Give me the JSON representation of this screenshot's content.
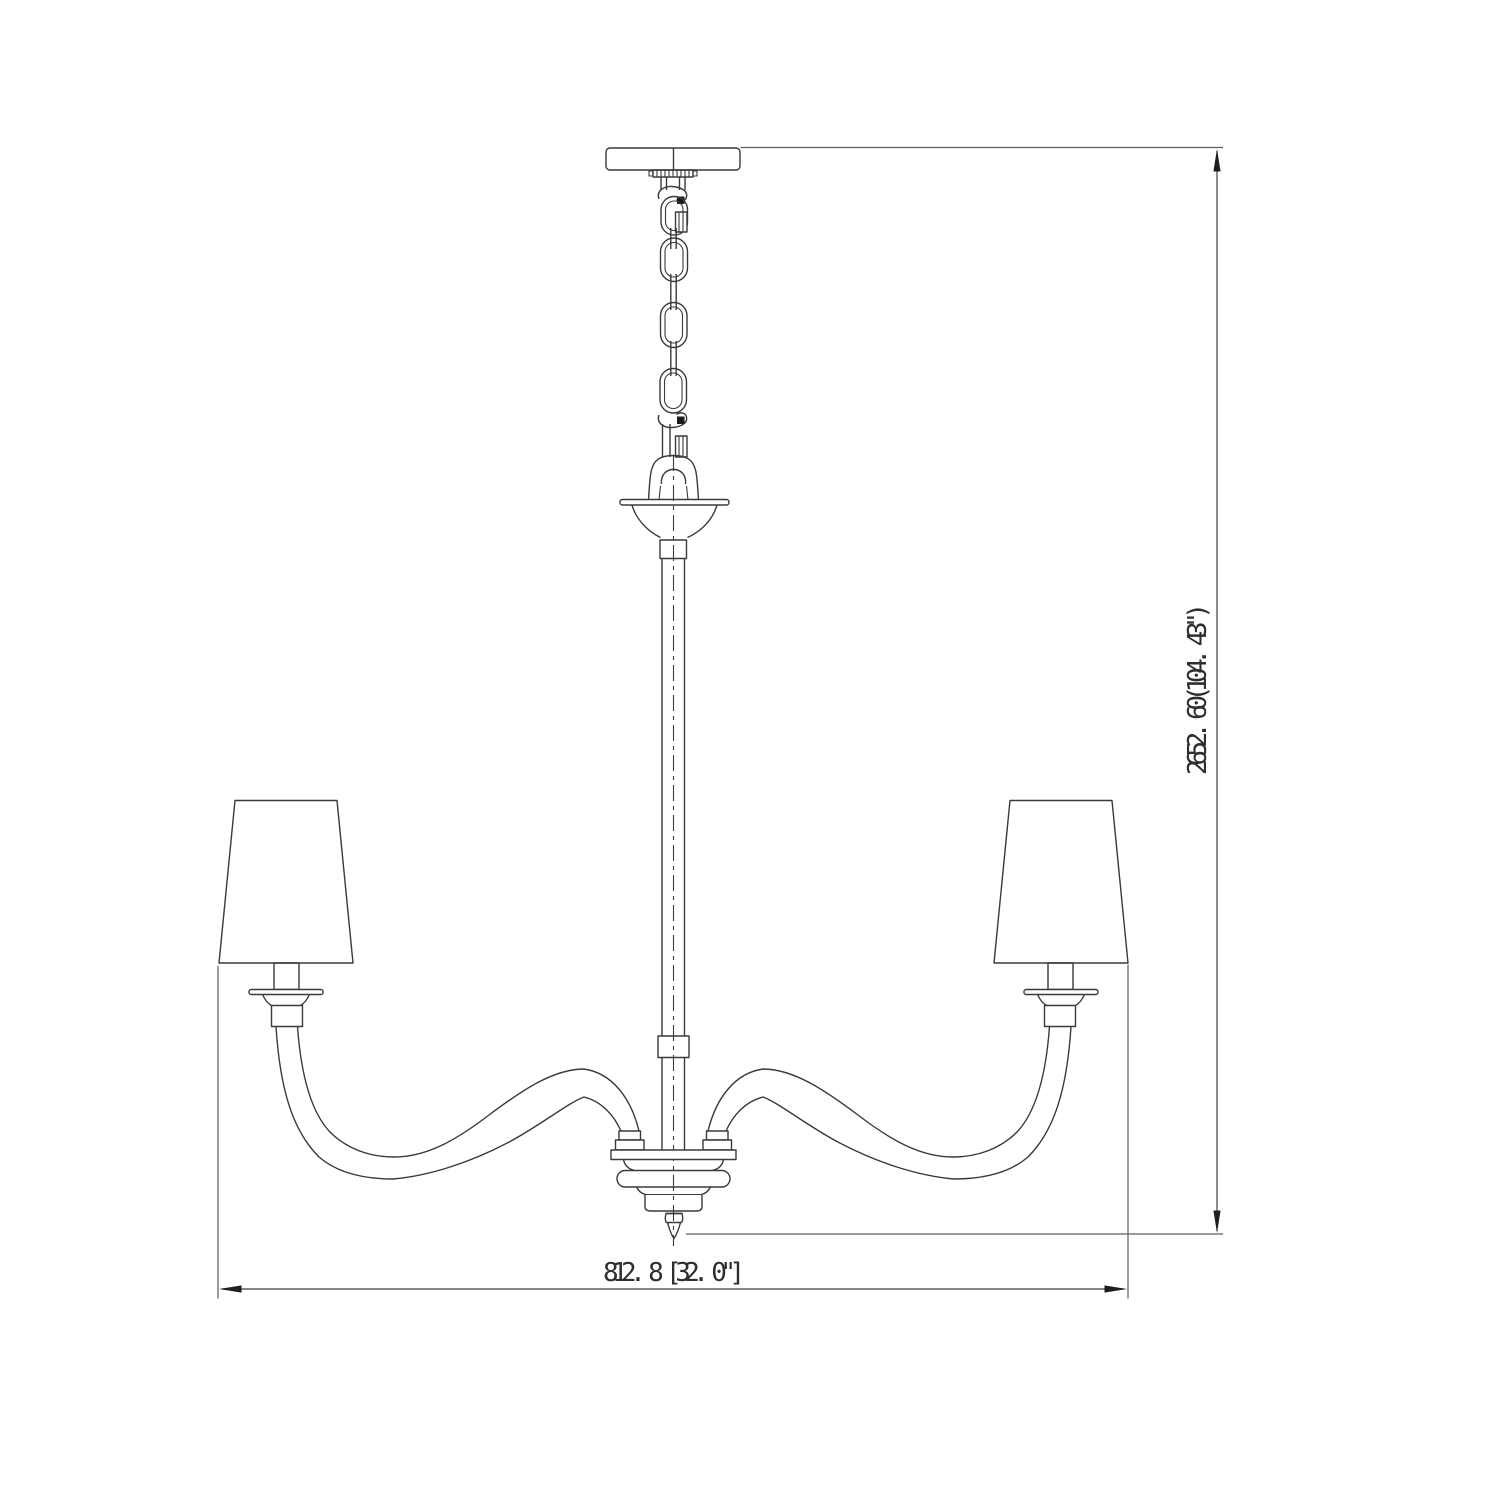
{
  "page": {
    "background_color": "#ffffff",
    "description": "Technical elevation line drawing of a two-arm chandelier with tapered shades, hanging chain and overall dimension callouts"
  },
  "drawing": {
    "subject": "chandelier-elevation",
    "stroke_color": "#3a3a3a",
    "extension_line_color": "#5e5e5e",
    "text_color": "#2e2e2e"
  },
  "dimensions": {
    "overall_height": {
      "label": "2652. 60(104. 43\")",
      "millimeters": "2652. 60",
      "inches": "104. 43\""
    },
    "overall_width": {
      "label": "812. 8 [32. 0\"]",
      "millimeters": "812. 8",
      "inches": "32. 0\""
    }
  }
}
